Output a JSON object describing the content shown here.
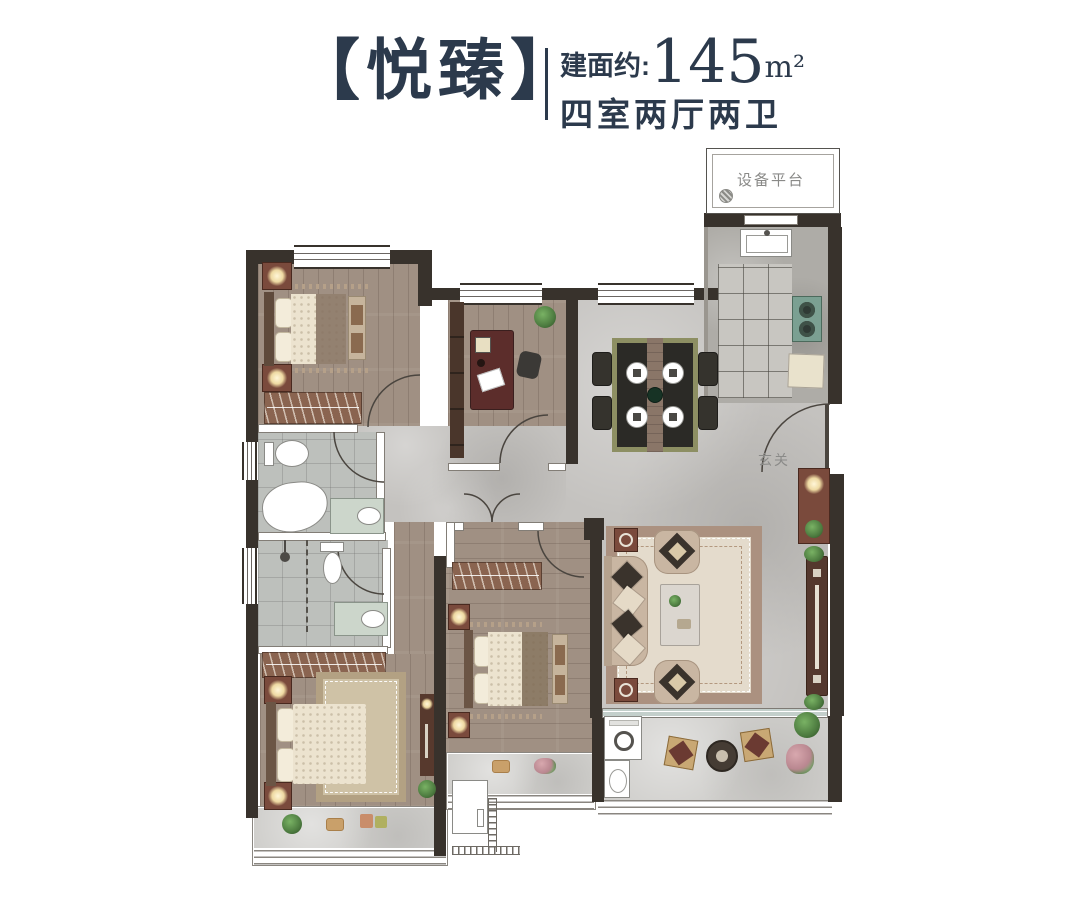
{
  "header": {
    "bracket_left": "【",
    "title": "悦臻",
    "bracket_right": "】",
    "area_prefix": "建面约:",
    "area_value": "145",
    "area_unit": "m²",
    "rooms_summary": "四室两厅两卫"
  },
  "plan_labels": {
    "equipment_platform": "设备平台",
    "entry": "玄关"
  },
  "colors": {
    "title_text": "#2c3a4c",
    "wall_dark": "#38322c",
    "wood_floor": "#a09083",
    "tile_gray": "#c4c2bf",
    "bath_tile": "#bdc0bc",
    "kitchen_stone": "#aeaca7",
    "marble_light": "#cfcecb",
    "rug_cream": "#e4dbcc",
    "rug_border": "#ab9180",
    "furniture_wine": "#7a4a3c",
    "wardrobe_wood": "#8a6450",
    "stove_teal": "#7ba092",
    "bedding_cream": "#ece3cf",
    "plant_green": "#4c7a3f",
    "label_gray": "#8a8a88"
  }
}
